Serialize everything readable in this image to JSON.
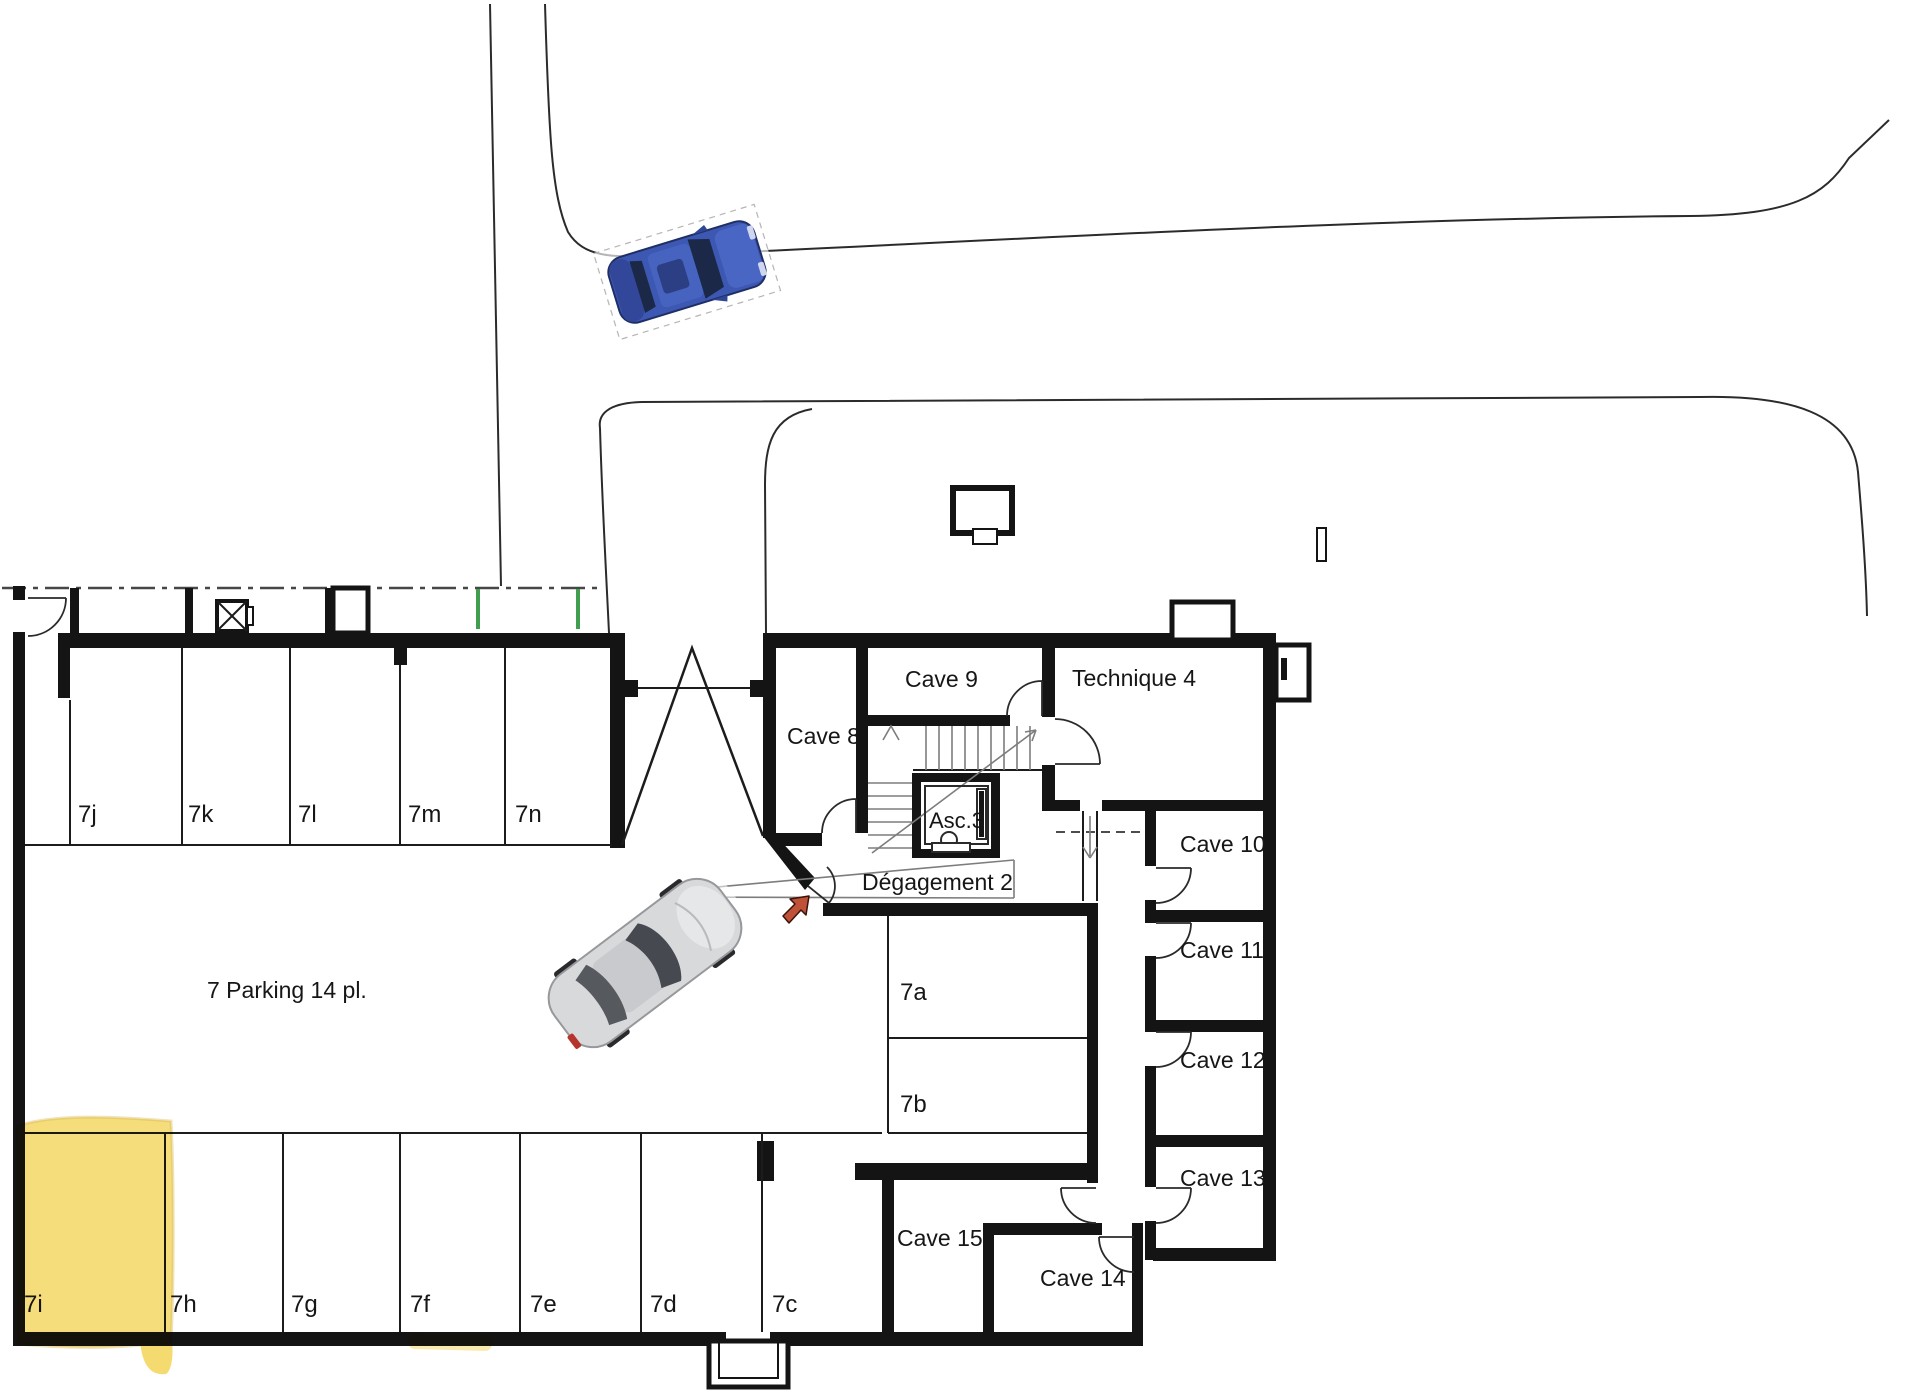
{
  "plan": {
    "title": "7 Parking 14 pl.",
    "rooms": {
      "cave8": "Cave 8",
      "cave9": "Cave 9",
      "cave10": "Cave 10",
      "cave11": "Cave 11",
      "cave12": "Cave 12",
      "cave13": "Cave 13",
      "cave14": "Cave 14",
      "cave15": "Cave 15",
      "technique": "Technique 4",
      "elevator": "Asc.3",
      "hallway": "Dégagement 2"
    },
    "stalls_top_row": [
      "7j",
      "7k",
      "7l",
      "7m",
      "7n"
    ],
    "stalls_bottom_row": [
      "7i",
      "7h",
      "7g",
      "7f",
      "7e",
      "7d",
      "7c"
    ],
    "stalls_side": [
      "7a",
      "7b"
    ],
    "highlighted_stall": "7i",
    "colors": {
      "highlight": "#f4d65f",
      "wall": "#141414",
      "tick_green": "#3f9e4f",
      "arrow_red": "#bf5138",
      "car_blue": "#3d58b2",
      "car_silver": "#d8d9db"
    }
  }
}
